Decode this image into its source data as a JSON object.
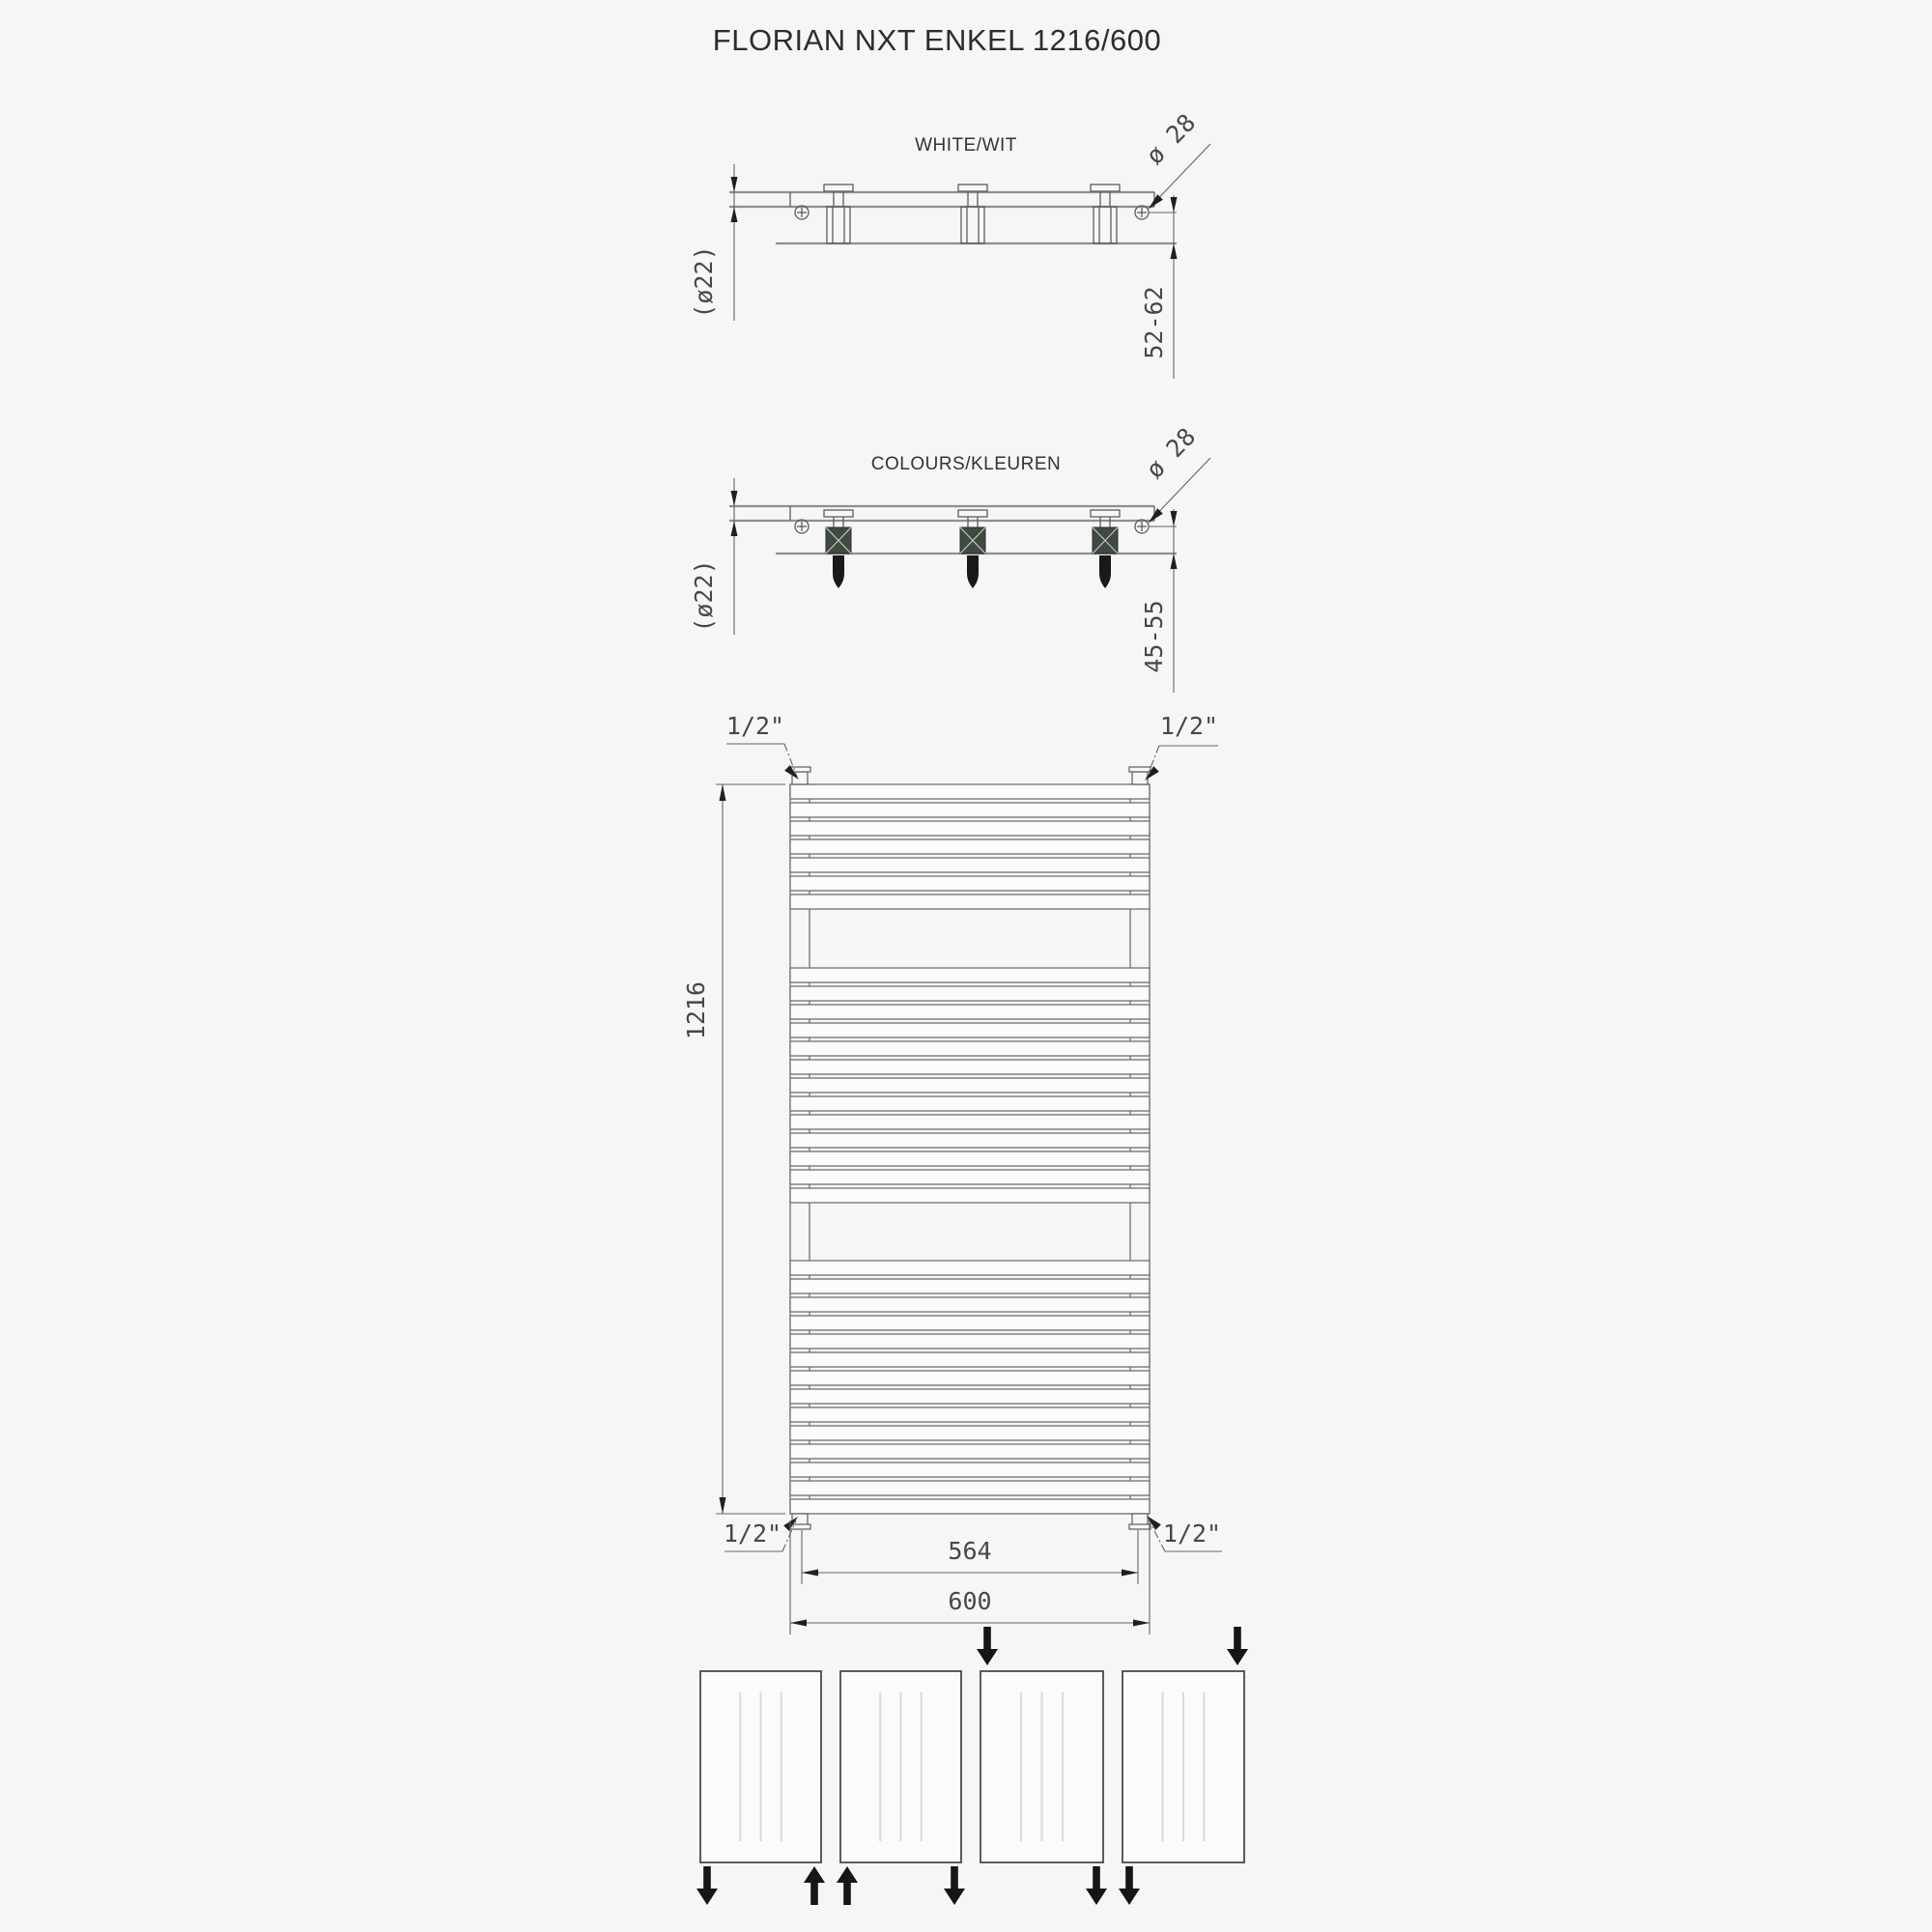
{
  "title": "FLORIAN NXT ENKEL 1216/600",
  "views": {
    "white": {
      "label": "WHITE/WIT",
      "bracket_dia": "ø 28",
      "tube_dia": "(ø22)",
      "wall_distance_range": "52-62"
    },
    "colours": {
      "label": "COLOURS/KLEUREN",
      "bracket_dia": "ø 28",
      "tube_dia": "(ø22)",
      "wall_distance_range": "45-55"
    }
  },
  "front_view": {
    "height": "1216",
    "connection_pitch": "564",
    "width": "600",
    "connections": {
      "top_left": "1/2\"",
      "top_right": "1/2\"",
      "bottom_left": "1/2\"",
      "bottom_right": "1/2\""
    },
    "tube_groups": [
      7,
      13,
      14
    ]
  },
  "connection_diagrams": {
    "panels": [
      {
        "arrows": [
          {
            "pos": "bottom-left",
            "dir": "down"
          },
          {
            "pos": "bottom-right",
            "dir": "up"
          }
        ]
      },
      {
        "arrows": [
          {
            "pos": "bottom-left",
            "dir": "up"
          },
          {
            "pos": "bottom-right",
            "dir": "down"
          }
        ]
      },
      {
        "arrows": [
          {
            "pos": "top-left",
            "dir": "down"
          },
          {
            "pos": "bottom-right",
            "dir": "down"
          }
        ]
      },
      {
        "arrows": [
          {
            "pos": "top-right",
            "dir": "down"
          },
          {
            "pos": "bottom-left",
            "dir": "down"
          }
        ]
      }
    ]
  },
  "colors": {
    "background": "#f6f6f6",
    "drawing_line": "#8f8f8f",
    "detail_line": "#5c5c5c",
    "text": "#3a3a3a",
    "arrow": "#161616"
  }
}
